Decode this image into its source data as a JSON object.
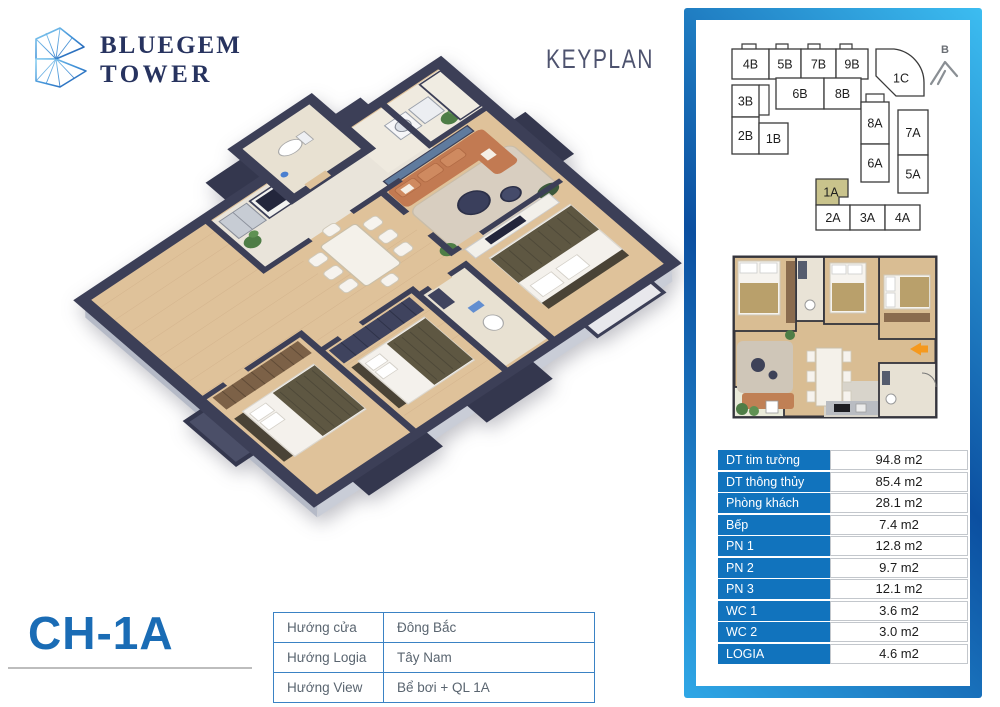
{
  "brand": {
    "name_line1": "BLUEGEM",
    "name_line2": "TOWER"
  },
  "keyplan_title": "KEYPLAN",
  "unit_title": "CH-1A",
  "keyplan": {
    "compass_label": "B",
    "highlighted_unit": "1A",
    "units": [
      "4B",
      "5B",
      "7B",
      "9B",
      "1C",
      "3B",
      "6B",
      "8B",
      "2B",
      "1B",
      "8A",
      "7A",
      "6A",
      "5A",
      "1A",
      "2A",
      "3A",
      "4A"
    ]
  },
  "area_table": {
    "rows": [
      {
        "label": "DT tim tường",
        "value": "94.8 m2"
      },
      {
        "label": "DT thông thủy",
        "value": "85.4 m2"
      },
      {
        "label": "Phòng khách",
        "value": "28.1 m2"
      },
      {
        "label": "Bếp",
        "value": "7.4 m2"
      },
      {
        "label": "PN 1",
        "value": "12.8 m2"
      },
      {
        "label": "PN 2",
        "value": "9.7 m2"
      },
      {
        "label": "PN 3",
        "value": "12.1 m2"
      },
      {
        "label": "WC 1",
        "value": "3.6 m2"
      },
      {
        "label": "WC 2",
        "value": "3.0 m2"
      },
      {
        "label": "LOGIA",
        "value": "4.6 m2"
      }
    ]
  },
  "direction_table": {
    "rows": [
      {
        "label": "Hướng cửa",
        "value": "Đông Bắc"
      },
      {
        "label": "Hướng Logia",
        "value": "Tây Nam"
      },
      {
        "label": "Hướng View",
        "value": "Bể bơi + QL 1A"
      }
    ]
  },
  "colors": {
    "accent_blue": "#1173bd",
    "title_blue": "#1a6cb5",
    "panel_gradient_dark": "#0b4fa0",
    "panel_gradient_light": "#3cbdf1",
    "highlight_khaki": "#c9c38c",
    "arrow_orange": "#f5991e"
  }
}
